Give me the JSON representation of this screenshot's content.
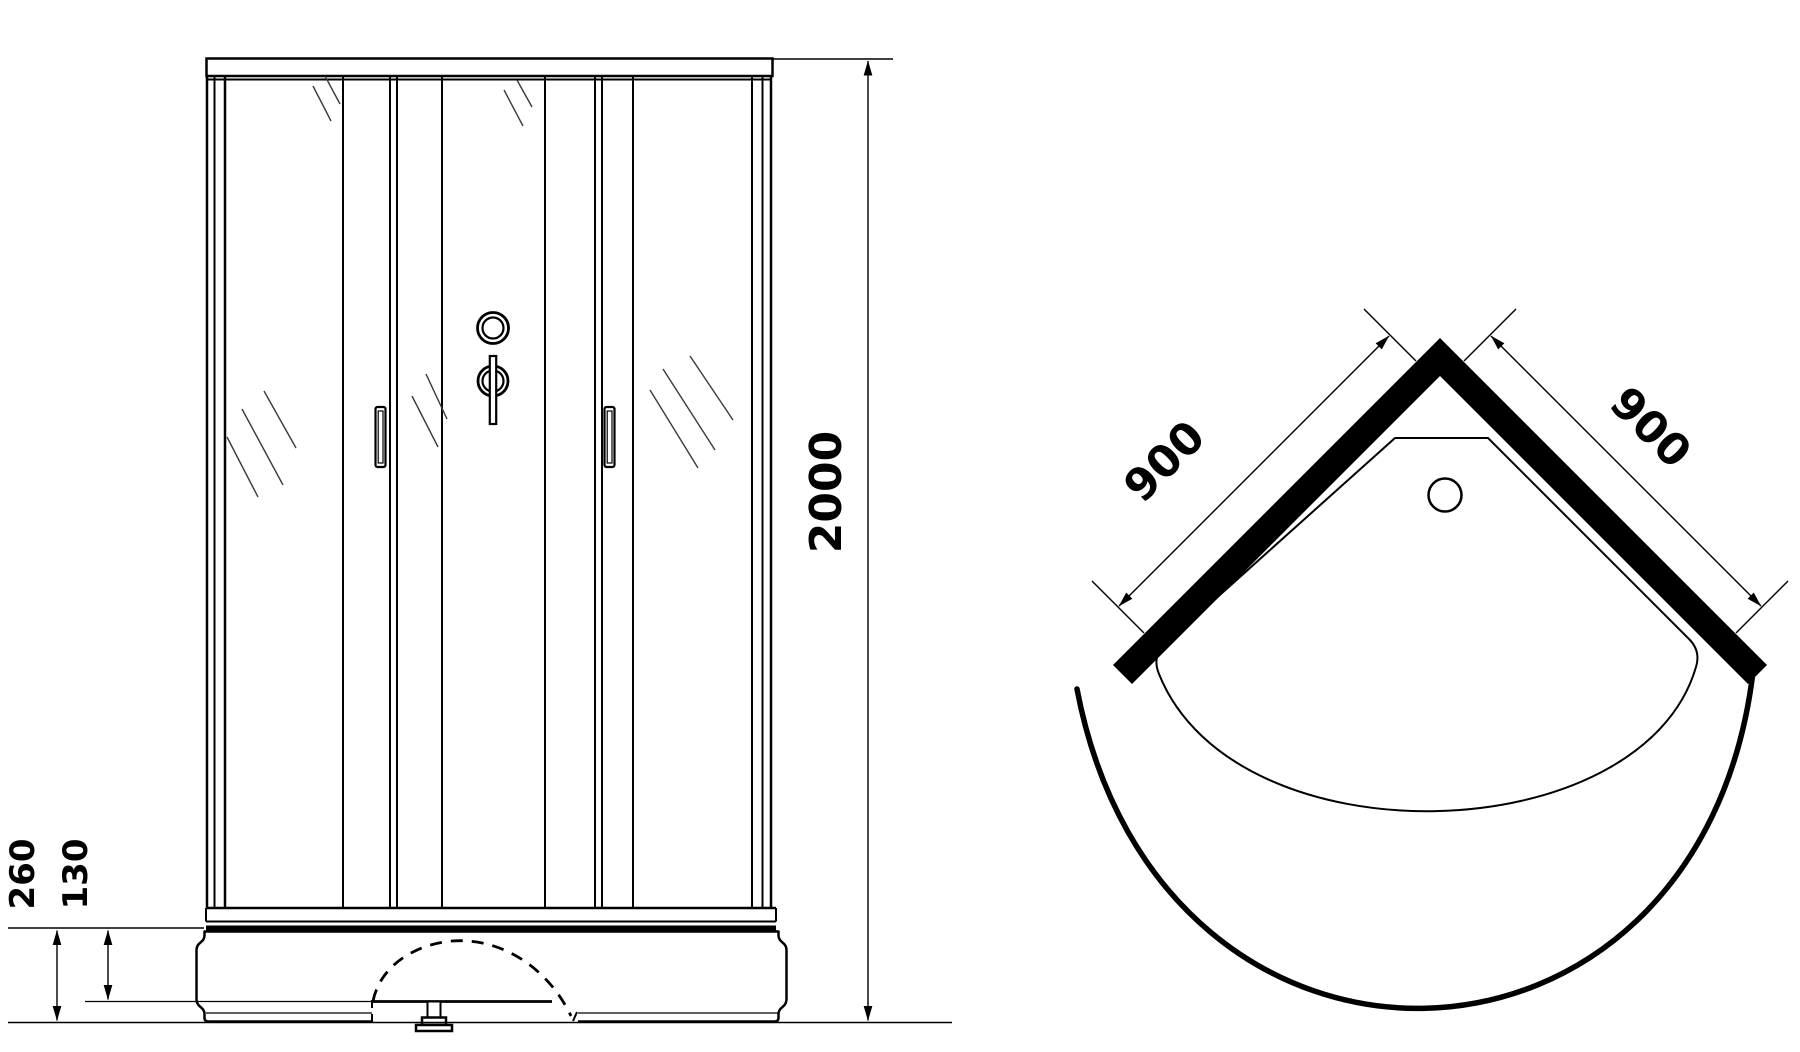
{
  "drawing": {
    "type": "shower-cabin-technical-drawing",
    "front_view": {
      "dimensions": {
        "height": "2000",
        "base_height": "260",
        "base_inner_height": "130"
      }
    },
    "top_view": {
      "dimensions": {
        "side_left": "900",
        "side_right": "900"
      }
    },
    "colors": {
      "line": "#000000",
      "background": "#ffffff",
      "hatch": "#3a3a3a",
      "wall_fill": "#000000"
    }
  }
}
